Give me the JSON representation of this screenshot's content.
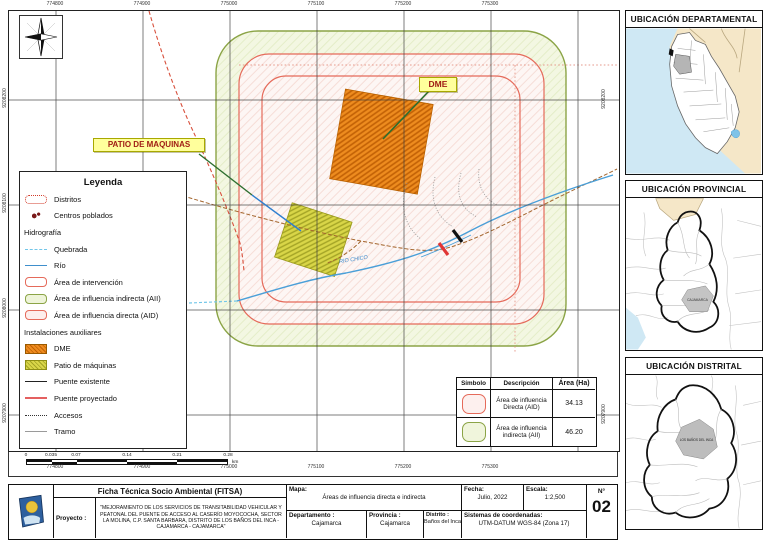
{
  "map": {
    "labels": {
      "dme": "DME",
      "patio": "PATIO DE MAQUINAS",
      "rio": "RIO CHICO"
    },
    "eastings": [
      "774800",
      "774900",
      "775000",
      "775100",
      "775200",
      "775300"
    ],
    "northings": [
      "9208200",
      "9208100",
      "9208000",
      "9207900"
    ],
    "northings_right": [
      "9208200",
      "9207900"
    ]
  },
  "legend": {
    "title": "Leyenda",
    "items": [
      {
        "label": "Distritos"
      },
      {
        "label": "Centros poblados"
      },
      {
        "label": "Hidrografía",
        "header": true
      },
      {
        "label": "Quebrada"
      },
      {
        "label": "Río"
      },
      {
        "label": "Área de intervención"
      },
      {
        "label": "Área de influencia indirecta (AII)"
      },
      {
        "label": "Área de influencia directa (AID)"
      },
      {
        "label": "Instalaciones auxiliares",
        "header": true
      },
      {
        "label": "DME"
      },
      {
        "label": "Patio de máquinas"
      },
      {
        "label": "Puente existente"
      },
      {
        "label": "Puente proyectado"
      },
      {
        "label": "Accesos"
      },
      {
        "label": "Tramo"
      }
    ]
  },
  "table": {
    "headers": [
      "Símbolo",
      "Descripción",
      "Área (Ha)"
    ],
    "rows": [
      {
        "desc": "Área de influencia Directa (AID)",
        "area": "34.13"
      },
      {
        "desc": "Área de influencia indirecta (AII)",
        "area": "46.20"
      }
    ]
  },
  "scalebar": {
    "ticks": [
      "0",
      "0.035",
      "0.07",
      "0.14",
      "0.21",
      "0.28"
    ],
    "unit": "km"
  },
  "sidebar": {
    "maps": [
      {
        "title": "UBICACIÓN DEPARTAMENTAL"
      },
      {
        "title": "UBICACIÓN PROVINCIAL",
        "region_label": "CAJAMARCA"
      },
      {
        "title": "UBICACIÓN DISTRITAL",
        "region_label": "LOS BAÑOS DEL INCA"
      }
    ]
  },
  "titleblock": {
    "doc_title": "Ficha Técnica Socio Ambiental (FITSA)",
    "proyecto_label": "Proyecto :",
    "proyecto_text": "\"MEJORAMIENTO DE LOS SERVICIOS DE TRANSITABILIDAD VEHICULAR Y PEATONAL DEL PUENTE DE ACCESO AL CASERÍO MOYOCOCHA, SECTOR LA MOLINA, C.P. SANTA BARBARA, DISTRITO DE LOS BAÑOS DEL INCA - CAJAMARCA - CAJAMARCA\"",
    "mapa_label": "Mapa:",
    "mapa_value": "Áreas de influencia directa e indirecta",
    "departamento_label": "Departamento :",
    "departamento_value": "Cajamarca",
    "provincia_label": "Provincia :",
    "provincia_value": "Cajamarca",
    "distrito_label": "Distrito :",
    "distrito_value": "Baños del Inca",
    "fecha_label": "Fecha:",
    "fecha_value": "Julio, 2022",
    "escala_label": "Escala:",
    "escala_value": "1:2,500",
    "coords_label": "Sistemas de coordenadas:",
    "coords_value": "UTM-DATUM WGS-84 (Zona 17)",
    "numero_label": "N°",
    "numero_value": "02"
  }
}
